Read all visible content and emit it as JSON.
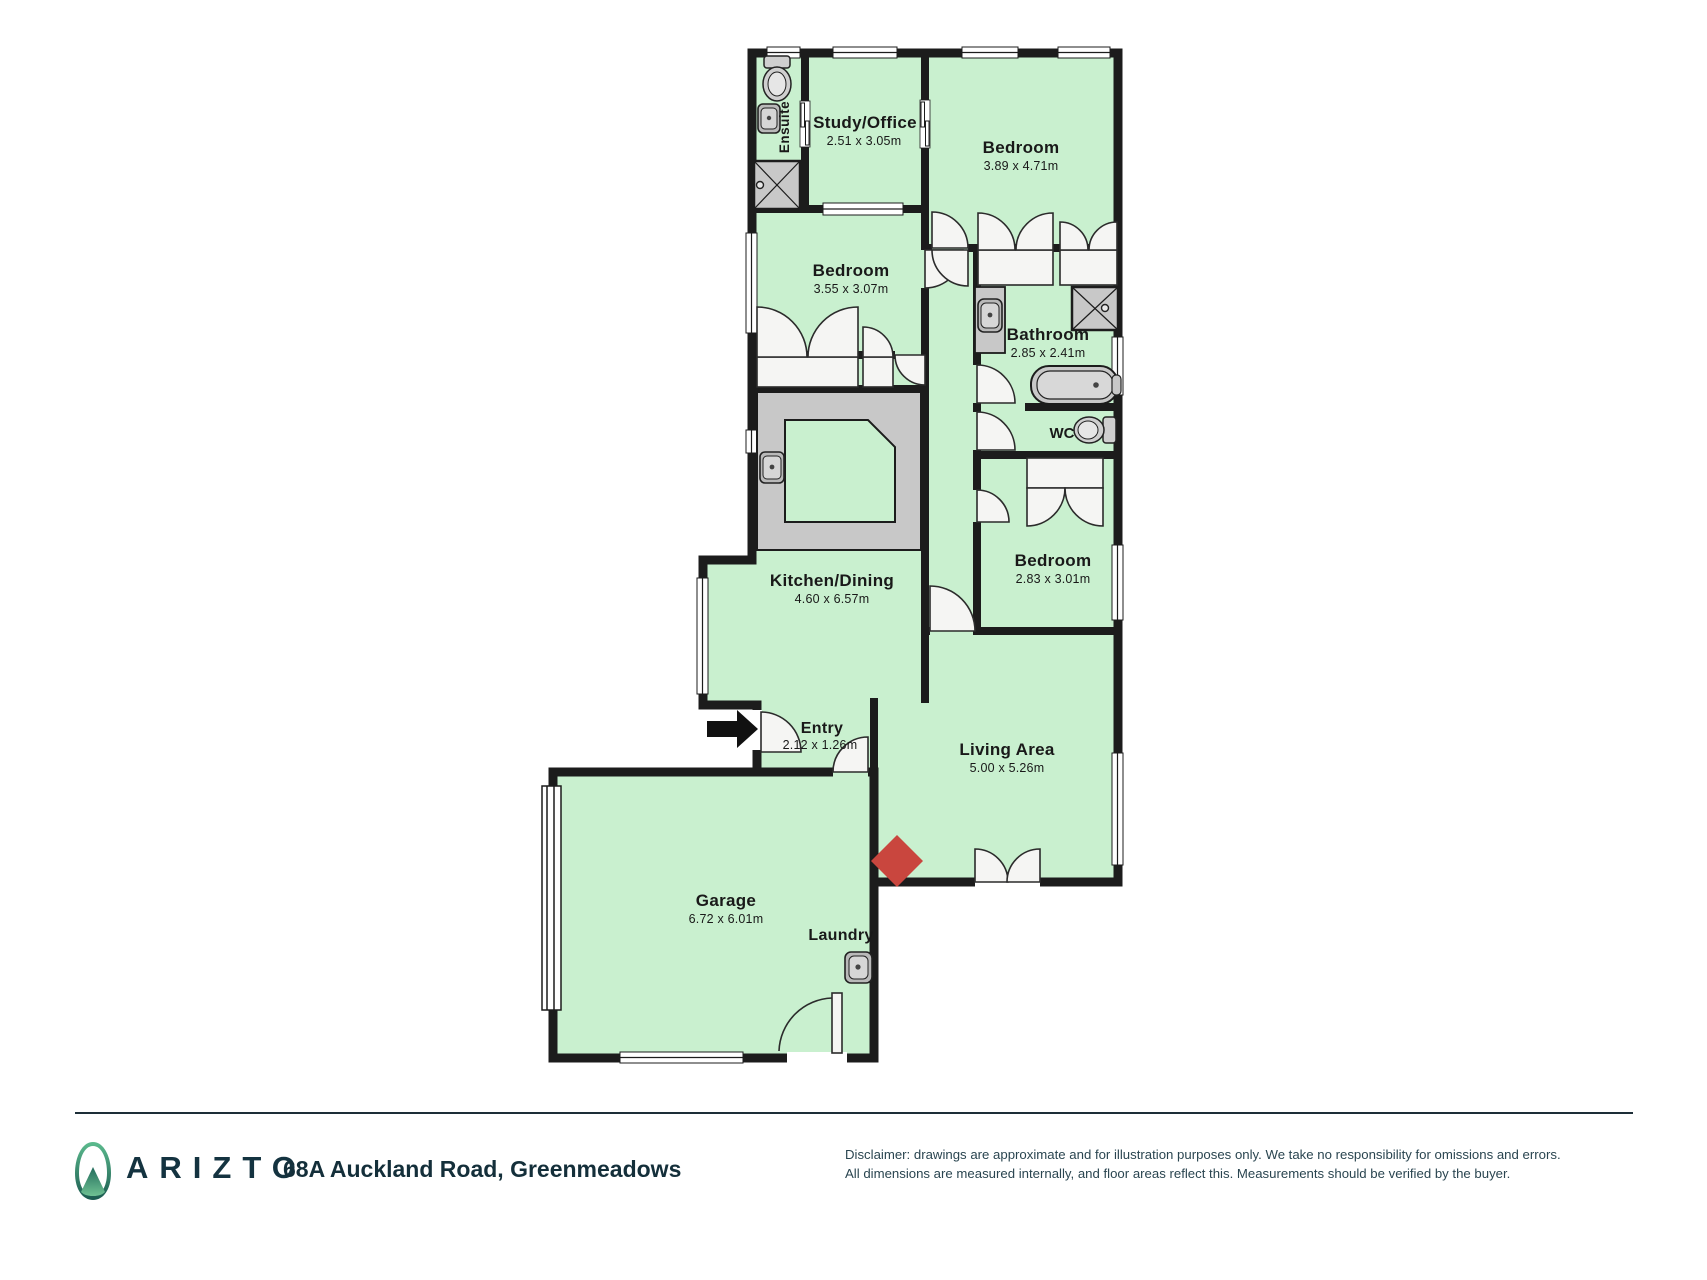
{
  "rooms": {
    "study": {
      "name": "Study/Office",
      "dims": "2.51 x 3.05m"
    },
    "bedroom1": {
      "name": "Bedroom",
      "dims": "3.89 x 4.71m"
    },
    "bedroom2": {
      "name": "Bedroom",
      "dims": "3.55 x 3.07m"
    },
    "bathroom": {
      "name": "Bathroom",
      "dims": "2.85 x 2.41m"
    },
    "wc": {
      "name": "WC"
    },
    "bedroom3": {
      "name": "Bedroom",
      "dims": "2.83 x 3.01m"
    },
    "kitchen": {
      "name": "Kitchen/Dining",
      "dims": "4.60 x 6.57m"
    },
    "entry": {
      "name": "Entry",
      "dims": "2.12 x 1.26m"
    },
    "living": {
      "name": "Living Area",
      "dims": "5.00 x 5.26m"
    },
    "garage": {
      "name": "Garage",
      "dims": "6.72 x 6.01m"
    },
    "laundry": {
      "name": "Laundry"
    },
    "ensuite": {
      "name": "Ensuite"
    }
  },
  "footer": {
    "brand": "ARIZTO",
    "address": "68A Auckland Road, Greenmeadows",
    "disclaimer_line1": "Disclaimer: drawings are approximate and for illustration purposes only. We take no responsibility for omissions and errors.",
    "disclaimer_line2": "All dimensions are measured internally, and floor areas reflect this. Measurements should be verified by the buyer."
  },
  "colors": {
    "floor_green": "#c9f0cf",
    "wall_black": "#1c1c1c",
    "fixture_gray": "#c8c8c8",
    "fireplace_red": "#c9463e",
    "brand_teal": "#143340"
  }
}
